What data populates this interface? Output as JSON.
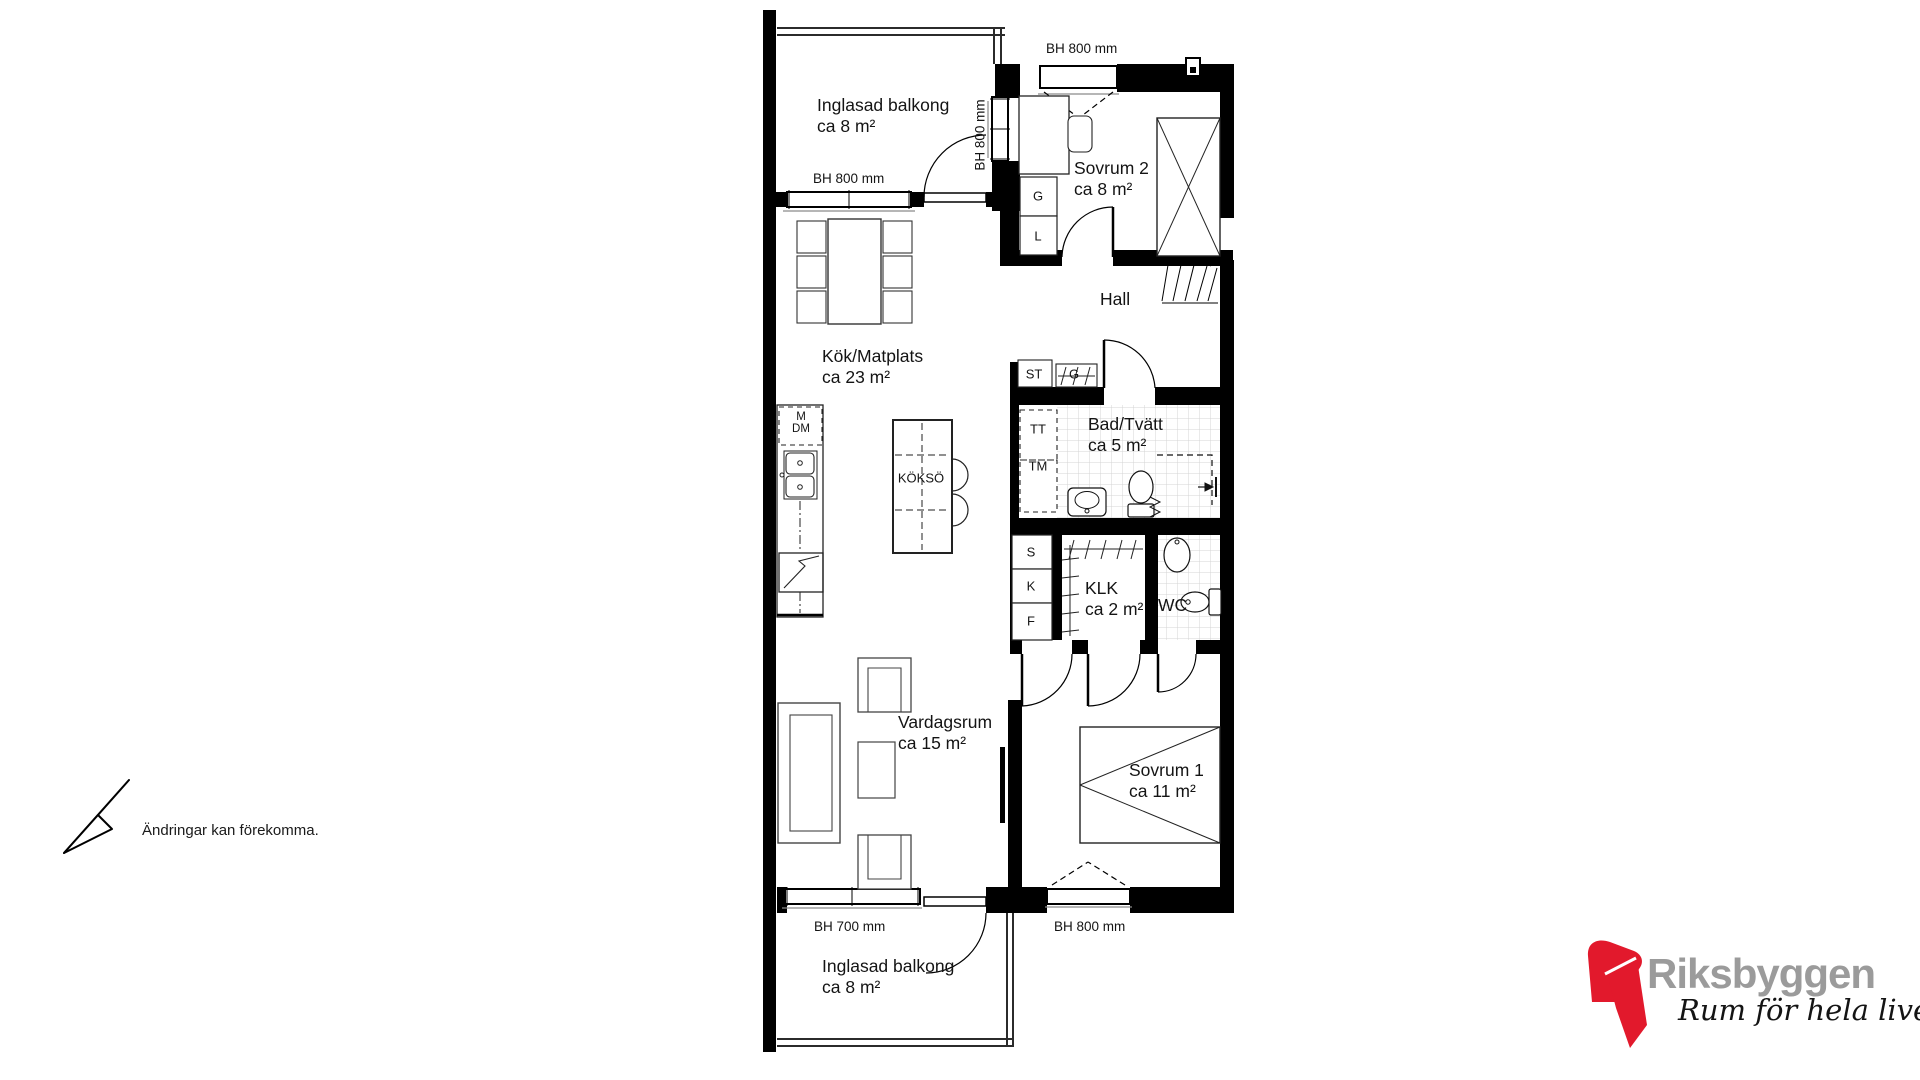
{
  "rooms": {
    "balcony_top": {
      "name": "Inglasad balkong",
      "area": "ca 8 m²"
    },
    "sovrum2": {
      "name": "Sovrum 2",
      "area": "ca 8 m²"
    },
    "hall": {
      "name": "Hall"
    },
    "kok_matplats": {
      "name": "Kök/Matplats",
      "area": "ca 23 m²"
    },
    "bad_tvatt": {
      "name": "Bad/Tvätt",
      "area": "ca 5 m²"
    },
    "klk": {
      "name": "KLK",
      "area": "ca 2 m²"
    },
    "wc": {
      "name": "WC"
    },
    "vardagsrum": {
      "name": "Vardagsrum",
      "area": "ca 15 m²"
    },
    "sovrum1": {
      "name": "Sovrum 1",
      "area": "ca 11 m²"
    },
    "balcony_bottom": {
      "name": "Inglasad balkong",
      "area": "ca 8 m²"
    }
  },
  "window_labels": {
    "balcony_top": "BH 800 mm",
    "balcony_side": "BH 800 mm",
    "sovrum2": "BH 800 mm",
    "vardagsrum": "BH 700 mm",
    "sovrum1": "BH 800 mm"
  },
  "fixtures": {
    "kokso": "KÖKSÖ",
    "m": "M",
    "dm": "DM",
    "g_sovrum": "G",
    "l_sovrum": "L",
    "st": "ST",
    "g_hall": "G",
    "tt": "TT",
    "tm": "TM",
    "s": "S",
    "k": "K",
    "f": "F"
  },
  "footer": {
    "disclaimer": "Ändringar kan förekomma."
  },
  "logo": {
    "brand": "Riksbyggen",
    "tagline": "Rum för hela livet",
    "red": "#e2192c",
    "gray": "#9b9b9b"
  }
}
